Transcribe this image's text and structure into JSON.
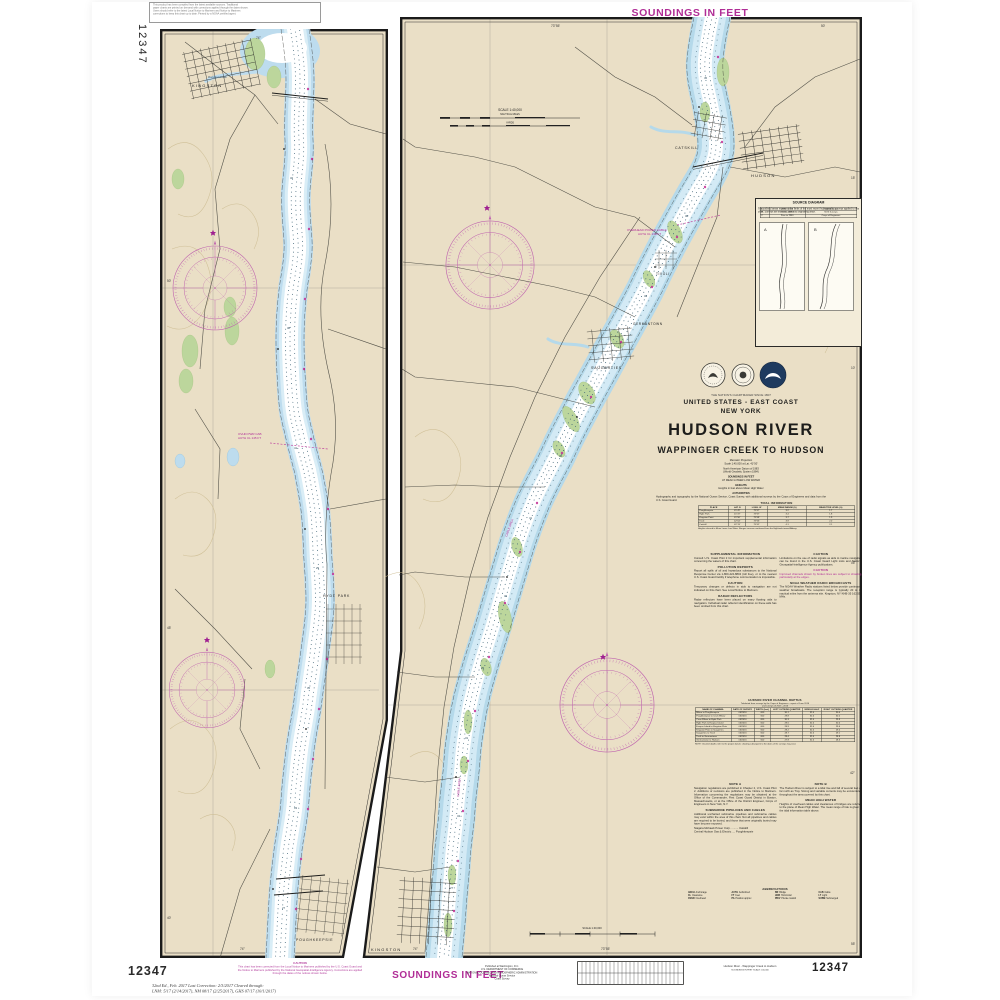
{
  "page": {
    "chart_number": "12347",
    "soundings_banner": "SOUNDINGS IN FEET"
  },
  "top_note": {
    "lines": [
      "This product has been compiled from the latest available sources. Traditional",
      "paper charts are printed on demand with corrections applied through the dates shown.",
      "Users should refer to the latest Local Notice to Mariners and Notice to Mariners",
      "corrections to keep this chart up to date. Printed by a NOAA certified agent."
    ]
  },
  "title_block": {
    "tagline": "THE NATION'S CHARTMAKER SINCE 1807",
    "series": "UNITED STATES - EAST COAST",
    "state": "NEW YORK",
    "title": "HUDSON RIVER",
    "subtitle": "WAPPINGER CREEK TO HUDSON",
    "projection": "Mercator Projection",
    "scale": "Scale 1:40,000 at Lat. 41°50'",
    "datum1": "North American Datum of 1983",
    "datum2": "(World Geodetic System 1984)",
    "sound1": "SOUNDINGS IN FEET",
    "sound2": "AT MEAN LOWER LOW WATER",
    "heights1": "HEIGHTS",
    "heights2": "Heights in feet above Mean High Water",
    "authorities_title": "AUTHORITIES",
    "authorities_body": "Hydrography and topography by the National Ocean Service, Coast Survey, with additional surveys by the Corps of Engineers and data from the U.S. Coast Guard."
  },
  "source_box": {
    "title": "SOURCE DIAGRAM",
    "body": "The outlined areas represent the limits of the most recent hydrographic surveys applied to this chart. Surveys are listed by date and originating office.",
    "rows": [
      [
        "A",
        "1981 - 2016",
        "NOS Surveys"
      ],
      [
        "B",
        "1940 - 1980",
        "NOS Surveys"
      ],
      [
        "C",
        "Prior to 1940",
        "Corps of Engineers"
      ]
    ]
  },
  "tidal_table": {
    "title": "TIDAL INFORMATION",
    "headers": [
      "PLACE",
      "LAT. N",
      "LONG. W",
      "MEAN RANGE (ft)",
      "MEAN TIDE LEVEL (ft)"
    ],
    "rows": [
      [
        "Poughkeepsie",
        "41°42'",
        "73°57'",
        "3.2",
        "1.7"
      ],
      [
        "Hyde Park",
        "41°47'",
        "73°57'",
        "3.4",
        "1.8"
      ],
      [
        "Kingston Point",
        "41°56'",
        "73°58'",
        "3.7",
        "1.9"
      ],
      [
        "Tivoli",
        "42°04'",
        "73°56'",
        "3.9",
        "2.0"
      ],
      [
        "Catskill",
        "42°13'",
        "73°52'",
        "4.1",
        "2.1"
      ]
    ],
    "footnote": "Heights referred to Mean Lower Low Water. Ranges increase northward from the Highlands toward Albany."
  },
  "channel_table": {
    "title1": "HUDSON RIVER CHANNEL DEPTHS",
    "title2": "Tabulated from surveys by the Corps of Engineers - report of June 2016",
    "title3": "and surveys of 2015 - 2016",
    "headers": [
      "NAME OF CHANNEL",
      "DATE OF SURVEY",
      "WIDTH (feet)",
      "LEFT OUTSIDE QUARTER",
      "MIDDLE HALF",
      "RIGHT OUTSIDE QUARTER"
    ],
    "rows": [
      [
        "Milton to Poughkeepsie",
        "06/2016",
        "600",
        "30.1",
        "32.0",
        "30.4"
      ],
      [
        "Poughkeepsie to Crum Elbow",
        "06/2016",
        "600",
        "29.8",
        "32.0",
        "30.2"
      ],
      [
        "Crum Elbow to Hyde Park",
        "06/2016",
        "600",
        "30.3",
        "32.0",
        "29.9"
      ],
      [
        "Hyde Park to Esopus Island",
        "06/2016",
        "600",
        "29.5",
        "32.0",
        "30.0"
      ],
      [
        "Esopus Island to Kingston Flats",
        "06/2016",
        "600",
        "28.9",
        "32.0",
        "29.6"
      ],
      [
        "Kingston Flats to Saugerties",
        "06/2016",
        "600",
        "29.2",
        "32.0",
        "29.4"
      ],
      [
        "Saugerties to Tivoli",
        "06/2016",
        "600",
        "28.7",
        "32.0",
        "29.1"
      ],
      [
        "Tivoli to Germantown",
        "06/2016",
        "600",
        "28.4",
        "32.0",
        "28.8"
      ],
      [
        "Germantown to Hudson",
        "06/2016",
        "600",
        "27.9",
        "32.0",
        "28.3"
      ]
    ],
    "footnote": "NOTE: Channel depths refer to the project datum; shoaling subsequent to the dates of the surveys may exist."
  },
  "notes": {
    "col1": [
      {
        "h": "SUPPLEMENTAL INFORMATION",
        "b": "Consult U.S. Coast Pilot 2 for important supplemental information concerning the waters of this chart."
      },
      {
        "h": "POLLUTION REPORTS",
        "b": "Report all spills of oil and hazardous substances to the National Response Center via 1-800-424-8802 (toll free), or to the nearest U.S. Coast Guard facility if telephone communication is impossible."
      },
      {
        "h": "CAUTION",
        "b": "Temporary changes or defects in aids to navigation are not indicated on this chart. See Local Notice to Mariners."
      },
      {
        "h": "RADAR REFLECTORS",
        "b": "Radar reflectors have been placed on many floating aids to navigation. Individual radar reflector identification on these aids has been omitted from this chart."
      }
    ],
    "col2": [
      {
        "h": "CAUTION",
        "b": "Limitations on the use of radio signals as aids to marine navigation can be found in the U.S. Coast Guard Light Lists and National Geospatial-Intelligence Agency publications."
      },
      {
        "h": "CAUTION",
        "m": true,
        "b": "Improved channels shown by broken lines are subject to shoaling, particularly at the edges."
      },
      {
        "h": "NOAA WEATHER RADIO BROADCASTS",
        "b": "The NOAA Weather Radio stations listed below provide continuous weather broadcasts. The reception range is typically 20 to 40 nautical miles from the antenna site. Kingston, NY  KHB-35  162.550 MHz."
      }
    ],
    "noteA": {
      "h": "NOTE A",
      "b": "Navigation regulations are published in Chapter 2, U.S. Coast Pilot 2. Additions or revisions are published in the Notice to Mariners. Information concerning the regulations may be obtained at the Office of the Commander, First Coast Guard District in Boston, Massachusetts, or at the Office of the District Engineer, Corps of Engineers in New York, N.Y."
    },
    "noteB": {
      "h": "NOTE B",
      "b": "The Hudson River is subject to a tidal rise and fall of several feet as far north as Troy. Strong and variable currents may be encountered throughout the area covered by this chart."
    },
    "pipelines": {
      "h": "SUBMARINE PIPELINES AND CABLES",
      "b": "Additional uncharted submarine pipelines and submarine cables may exist within the area of this chart. Not all pipelines and cables are required to be buried, and those that were originally buried may have become exposed."
    },
    "pipelines_list": [
      "Niagara Mohawk Power Corp. ......... Catskill",
      "Central Hudson Gas & Electric .... Poughkeepsie"
    ],
    "mhw": {
      "h": "MEAN HIGH WATER",
      "b": "Heights of overhead cables and clearances of bridges are referred to the plane of Mean High Water. The mean range of tide is given in the tidal information table above."
    }
  },
  "abbreviations": {
    "title": "ABBREVIATIONS",
    "items": [
      [
        "ANCH",
        "Anchorage"
      ],
      [
        "AUTH",
        "Authorized"
      ],
      [
        "BR",
        "Bridge"
      ],
      [
        "CAB",
        "Cable"
      ],
      [
        "CL",
        "Clearance"
      ],
      [
        "FT",
        "Feet"
      ],
      [
        "HOR",
        "Horizontal"
      ],
      [
        "LT",
        "Light"
      ],
      [
        "OVHD",
        "Overhead"
      ],
      [
        "PA",
        "Position approx"
      ],
      [
        "PRIV",
        "Private maintd"
      ],
      [
        "SUBM",
        "Submerged"
      ]
    ]
  },
  "scalebars": {
    "top_title": "SCALE 1:40,000",
    "top_units1": "NAUTICAL MILES",
    "top_units2": "YARDS",
    "bottom_title": "SCALE 1:40,000"
  },
  "bottom": {
    "caution_title": "CAUTION",
    "caution_body": "This chart has been corrected from the Local Notice to Mariners published by the U.S. Coast Guard and the Notice to Mariners published by the National Geospatial-Intelligence Agency. Corrections are applied through the dates of the notices shown below.",
    "edition_line1": "32nd Ed., Feb. 2017    Last Correction: 2/3/2017    Cleared through:",
    "edition_line2": "LNM: 5/17 (2/14/2017),   NM 08/17 (2/25/2017),   GHS 07/17 (10/1/2017)",
    "pub_lines": [
      "Published at Washington, D.C.",
      "U.S. DEPARTMENT OF COMMERCE",
      "NATIONAL OCEANIC AND ATMOSPHERIC ADMINISTRATION",
      "National Ocean Service",
      "Coast Survey"
    ],
    "product_title": "Hudson River - Wappinger Creek to Hudson",
    "product_sub": "SOUNDINGS IN FEET   SCALE 1:40,000"
  },
  "map_labels": {
    "left": {
      "city_top": "KINGSTON",
      "city_mid": "HYDE PARK",
      "city_bottom": "POUGHKEEPSIE",
      "creek": "Rondout Creek",
      "cable1": "OVHD PWR CAB",
      "cable2": "AUTH CL 145 FT",
      "lat1": "50'",
      "lat2": "45'",
      "lat3": "40'",
      "lon_top": "74°",
      "lon_bottom": "74°",
      "s1": "32",
      "s2": "38",
      "s3": "41",
      "s4": "29",
      "s5": "35",
      "s6": "33",
      "s7": "27"
    },
    "right": {
      "city1": "HUDSON",
      "city2": "CATSKILL",
      "city3": "SAUGERTIES",
      "city4": "TIVOLI",
      "city5": "GERMANTOWN",
      "city6": "KINGSTON",
      "cable1": "OVERHEAD POWER CABLE",
      "cable2": "AUTH CL 139 FT",
      "cablearea1": "CABLE AREA",
      "cablearea2": "CABLE AREA",
      "lat1": "15'",
      "lat2": "10'",
      "lat3": "05'",
      "lat4": "42°",
      "lat5": "55'",
      "lon_top1": "73°55'",
      "lon_top2": "50'",
      "lon_bottom1": "74°",
      "lon_bottom2": "73°55'",
      "s1": "45",
      "s2": "38",
      "s3": "32",
      "s4": "30",
      "s5": "36",
      "s6": "41",
      "s7": "33",
      "s8": "29",
      "s9": "31",
      "s10": "34",
      "s11": "27"
    },
    "source_a": "A",
    "source_b": "B"
  }
}
